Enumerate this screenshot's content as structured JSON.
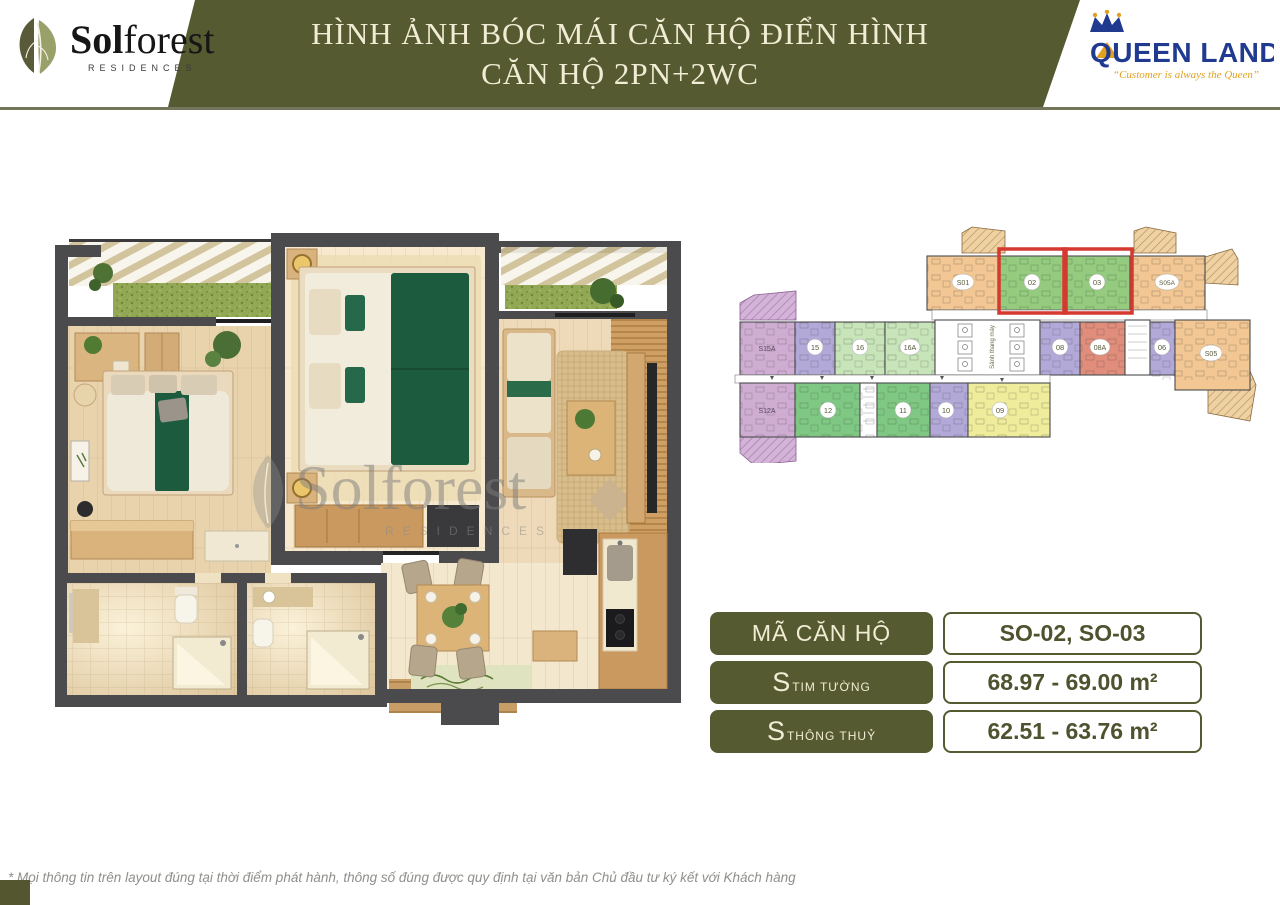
{
  "header": {
    "banner": {
      "title_line1": "HÌNH ẢNH BÓC MÁI CĂN HỘ ĐIỂN HÌNH",
      "title_line2": "CĂN HỘ 2PN+2WC",
      "bg_color": "#565a31",
      "text_color": "#f1ecd4"
    },
    "solforest_logo": {
      "name_bold": "Sol",
      "name_rest": "forest",
      "subtitle": "RESIDENCES"
    },
    "queenland_logo": {
      "name": "QUEEN LAND",
      "tagline": "“Customer is always the Queen”",
      "name_color": "#1f3a8f",
      "tagline_color": "#e2a01f"
    }
  },
  "floorplan_3d": {
    "watermark": "Solforest",
    "watermark_sub": "RESIDENCES"
  },
  "site_plan": {
    "core_label": "Sảnh thang máy",
    "highlight_color": "#d6392f",
    "units": [
      {
        "id": "S01",
        "color": "#f2c793"
      },
      {
        "id": "02",
        "color": "#94cb7e"
      },
      {
        "id": "03",
        "color": "#94cb7e"
      },
      {
        "id": "S05A",
        "color": "#f2c793"
      },
      {
        "id": "S15A",
        "color": "#cfadd3"
      },
      {
        "id": "15",
        "color": "#b2a9d8"
      },
      {
        "id": "16",
        "color": "#c8e5ba"
      },
      {
        "id": "16A",
        "color": "#c8e5ba"
      },
      {
        "id": "08",
        "color": "#b2a9d8"
      },
      {
        "id": "08A",
        "color": "#e18d7c"
      },
      {
        "id": "06",
        "color": "#b2a9d8"
      },
      {
        "id": "S05",
        "color": "#f2c793"
      },
      {
        "id": "S12A",
        "color": "#cfadd3"
      },
      {
        "id": "12",
        "color": "#7fc883"
      },
      {
        "id": "11",
        "color": "#7fc883"
      },
      {
        "id": "10",
        "color": "#b2a9d8"
      },
      {
        "id": "09",
        "color": "#efec9b"
      }
    ]
  },
  "info_table": {
    "rows": [
      {
        "label": "MÃ CĂN HỘ",
        "label_sub": "",
        "value": "SO-02, SO-03"
      },
      {
        "label": "S",
        "label_sub": "TIM TƯỜNG",
        "value": "68.97 - 69.00 m²"
      },
      {
        "label": "S",
        "label_sub": "THÔNG THUỶ",
        "value": "62.51 - 63.76 m²"
      }
    ]
  },
  "footnote": "* Mọi thông tin trên layout đúng tại thời điểm phát hành, thông số đúng được quy định tại văn bản Chủ đầu tư ký kết với Khách hàng"
}
